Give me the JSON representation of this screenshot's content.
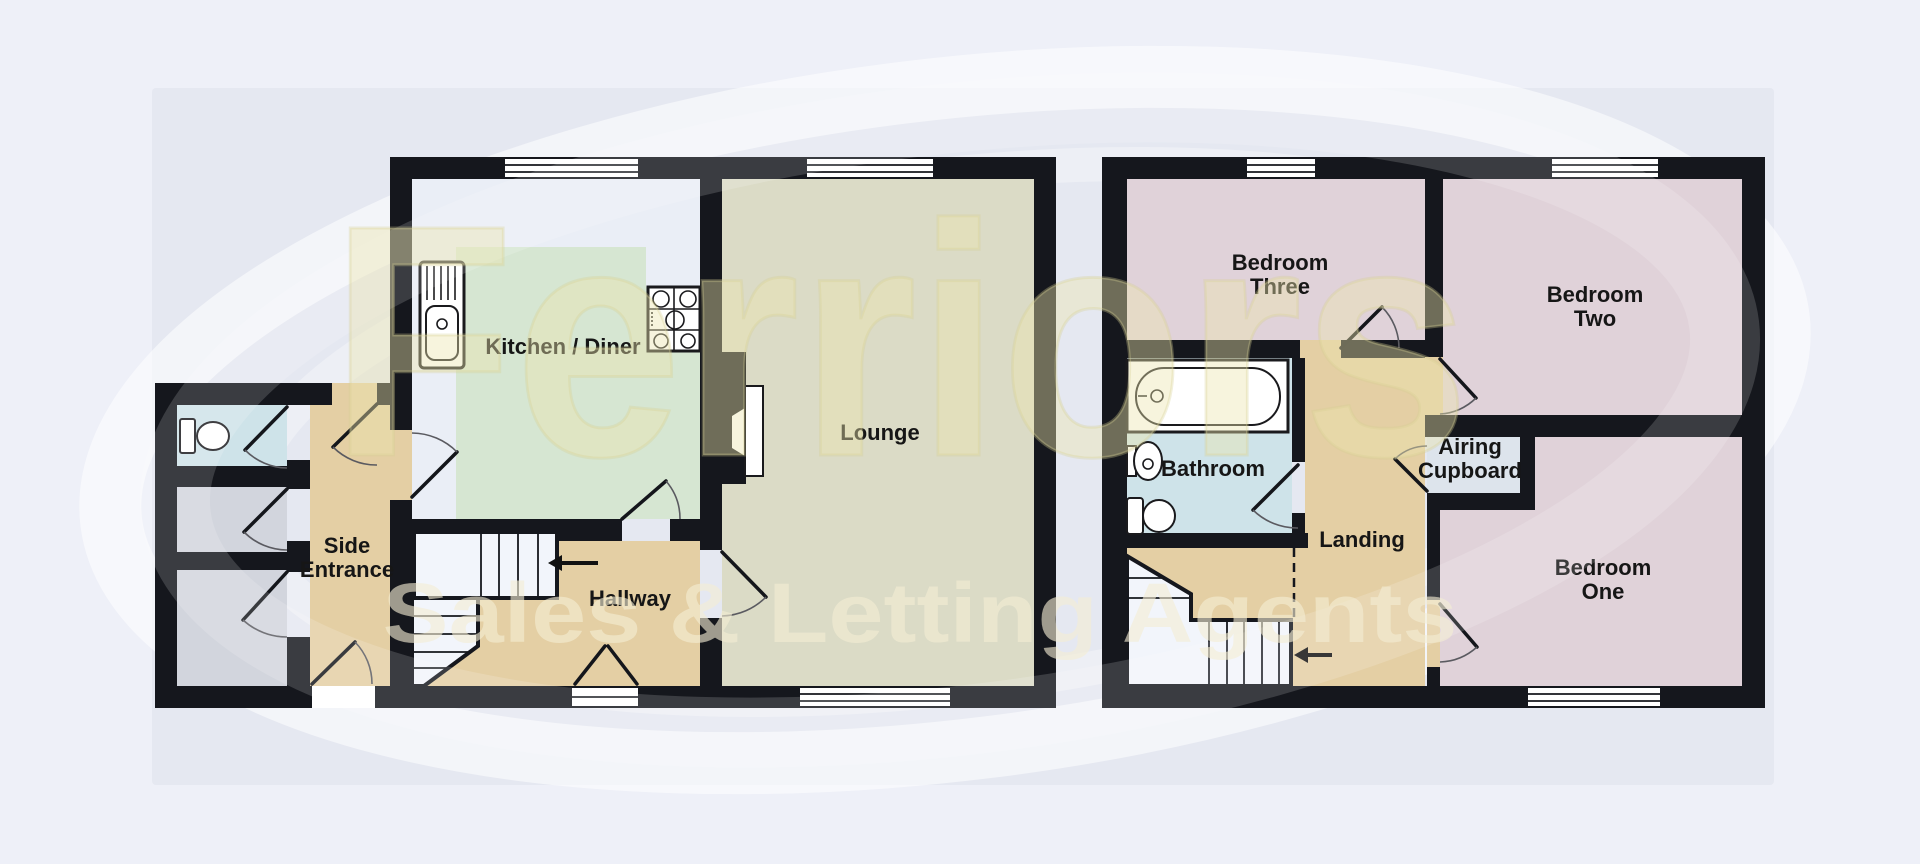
{
  "watermark": {
    "brand": "Ferriors",
    "tagline": "Sales & Letting Agents"
  },
  "ground_floor": {
    "rooms": {
      "kitchen_diner": {
        "label": "Kitchen / Diner"
      },
      "lounge": {
        "label": "Lounge"
      },
      "side_entrance": {
        "line1": "Side",
        "line2": "Entrance"
      },
      "hallway": {
        "label": "Hallway"
      }
    },
    "fixtures": [
      "sink-drainer-unit",
      "gas-hob",
      "toilet",
      "staircase",
      "up-arrow",
      "chimney-breast",
      "entrance-doors",
      "windows"
    ]
  },
  "first_floor": {
    "rooms": {
      "bedroom_three": {
        "line1": "Bedroom",
        "line2": "Three"
      },
      "bedroom_two": {
        "line1": "Bedroom",
        "line2": "Two"
      },
      "bathroom": {
        "label": "Bathroom"
      },
      "airing_cupboard": {
        "line1": "Airing",
        "line2": "Cupboard"
      },
      "landing": {
        "label": "Landing"
      },
      "bedroom_one": {
        "line1": "Bedroom",
        "line2": "One"
      }
    },
    "fixtures": [
      "bath",
      "wash-basin",
      "toilet",
      "staircase",
      "down-arrow",
      "windows"
    ]
  },
  "colors": {
    "wall": "#15171d",
    "floor-kitchen": "#d6e6d2",
    "floor-kitchen-base": "#eaeef6",
    "floor-lounge": "#dbdbc6",
    "floor-tan": "#e4cfa4",
    "floor-pink": "#e0d2d9",
    "floor-blue": "#cee3e9",
    "floor-gray": "#d2d5dd",
    "floor-cupboard": "#dde4ec",
    "page-bg": "#eef0f8",
    "backdrop": "#e5e8f1",
    "label-text": "#161616",
    "watermark-fill": "#ece4ae",
    "watermark-tagline": "#f4eed4"
  }
}
